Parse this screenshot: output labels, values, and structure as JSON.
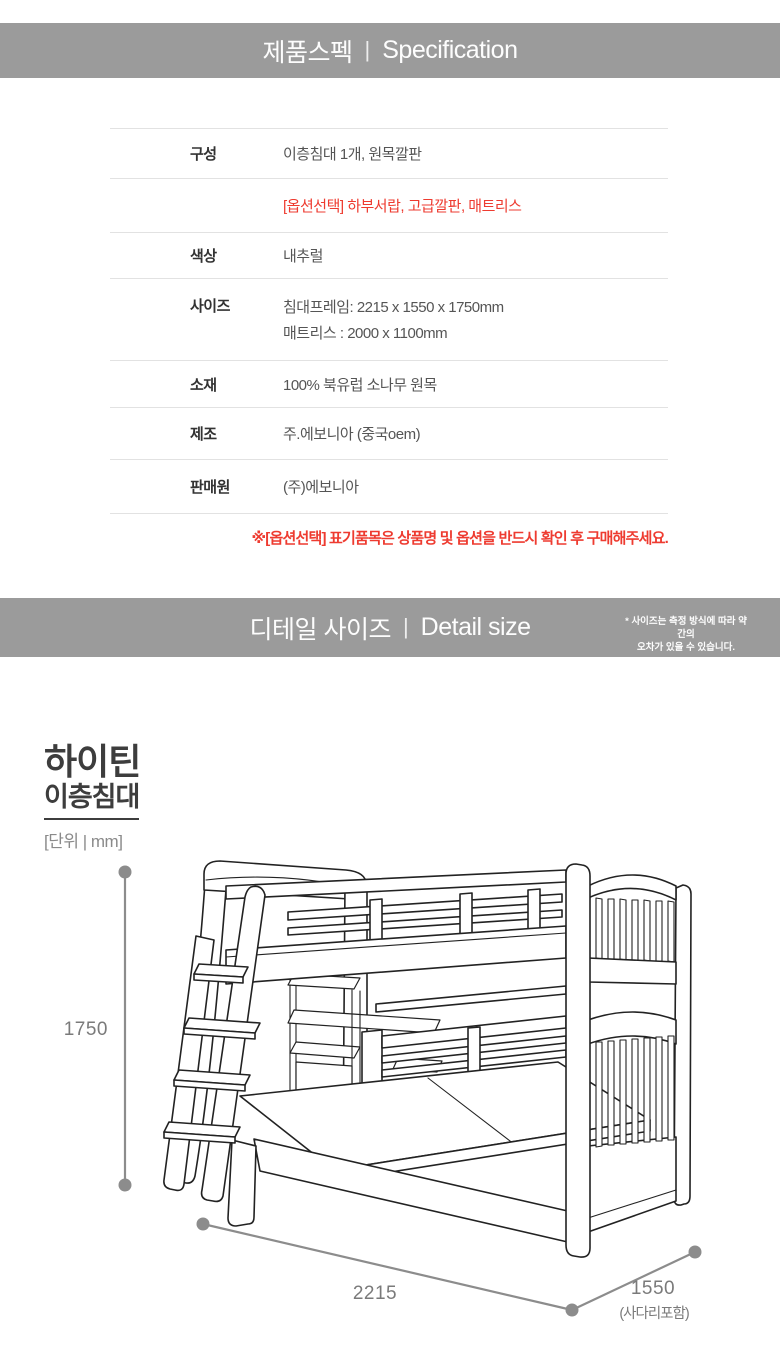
{
  "colors": {
    "banner_bg": "#9b9b9b",
    "banner_text": "#fdfdfd",
    "accent_red": "#ee3b30",
    "label_text": "#333333",
    "value_text": "#555555",
    "table_border": "#e2e2e2",
    "dimension_gray": "#8c8c8c",
    "drawing_line": "#222222"
  },
  "spec_banner": {
    "title_ko": "제품스펙",
    "divider": "|",
    "title_en": "Specification"
  },
  "spec_table": {
    "rows": [
      {
        "label": "구성",
        "value": "이층침대 1개, 원목깔판"
      },
      {
        "label": "",
        "value": "[옵션선택] 하부서랍, 고급깔판, 매트리스"
      },
      {
        "label": "색상",
        "value": "내추럴"
      },
      {
        "label": "사이즈",
        "value": "침대프레임: 2215 x 1550 x 1750mm",
        "value2": "매트리스 : 2000 x 1100mm"
      },
      {
        "label": "소재",
        "value": "100% 북유럽 소나무 원목"
      },
      {
        "label": "제조",
        "value": "주.에보니아 (중국oem)"
      },
      {
        "label": "판매원",
        "value": "(주)에보니아"
      }
    ],
    "footnote": "※[옵션선택] 표기품목은 상품명 및 옵션을 반드시 확인 후 구매해주세요."
  },
  "detail_banner": {
    "title_ko": "디테일 사이즈",
    "divider": "|",
    "title_en": "Detail size",
    "note_line1": "* 사이즈는 측정 방식에 따라 약간의",
    "note_line2": "오차가 있을 수 있습니다."
  },
  "detail": {
    "product_name_line1": "하이틴",
    "product_name_line2": "이층침대",
    "unit_label": "[단위 | mm]",
    "dimensions": {
      "height": "1750",
      "length": "2215",
      "depth": "1550",
      "depth_note": "(사다리포함)"
    }
  }
}
